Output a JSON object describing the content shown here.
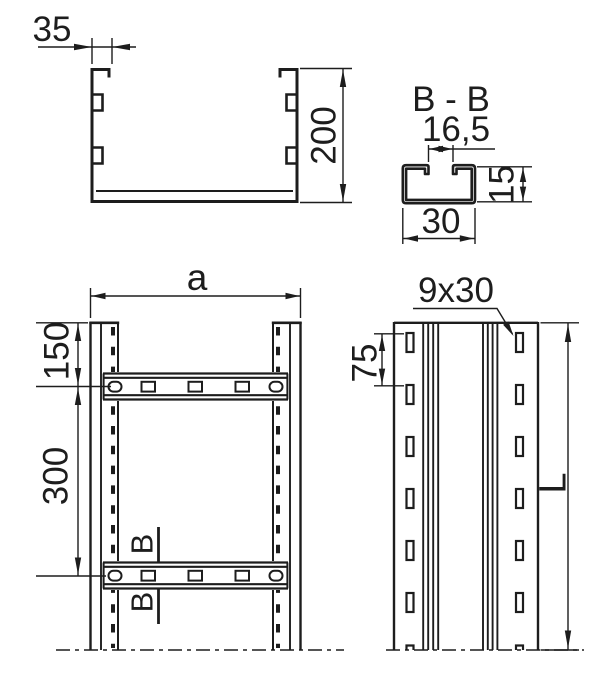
{
  "palette": {
    "background": "#ffffff",
    "ink": "#1d1d1d"
  },
  "drawing": {
    "type": "technical-drawing",
    "subject": "cable-ladder dimensioned views",
    "views": {
      "cross_section": {
        "flange_width": "35",
        "height": "200"
      },
      "section_bb": {
        "title": "B - B",
        "opening_width": "16,5",
        "profile_height": "15",
        "profile_width": "30"
      },
      "plan": {
        "overall_width": "a",
        "end_to_first_rung": "150",
        "rung_pitch": "300",
        "cut_label_top": "B",
        "cut_label_bottom": "B"
      },
      "side": {
        "slot_size": "9x30",
        "slot_pitch": "75",
        "length": "L"
      }
    }
  }
}
